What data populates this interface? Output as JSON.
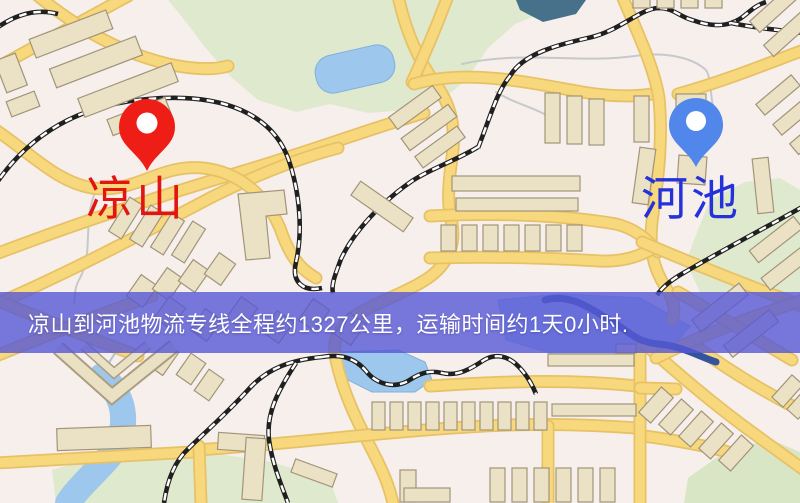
{
  "map": {
    "banner": {
      "text": "凉山到河池物流专线全程约1327公里，运输时间约1天0小时.",
      "bg_color": "#5658d6",
      "text_color": "#ffffff"
    },
    "markers": [
      {
        "id": "origin",
        "label": "凉山",
        "pin_color": "#ee1d16",
        "label_color": "#e21511"
      },
      {
        "id": "destination",
        "label": "河池",
        "pin_color": "#5187ea",
        "label_color": "#2532db"
      }
    ],
    "route": {
      "origin": "凉山",
      "destination": "河池",
      "distance": "1327公里",
      "duration": "1天0小时"
    },
    "colors": {
      "background": "#f7efeb",
      "road_fill": "#f8d87d",
      "road_casing": "#e7c166",
      "water": "#9dc7ed",
      "water_dark": "#35549e",
      "green": "#dfe9cd",
      "building": "#ebe2c6",
      "railway": "#202020"
    }
  }
}
